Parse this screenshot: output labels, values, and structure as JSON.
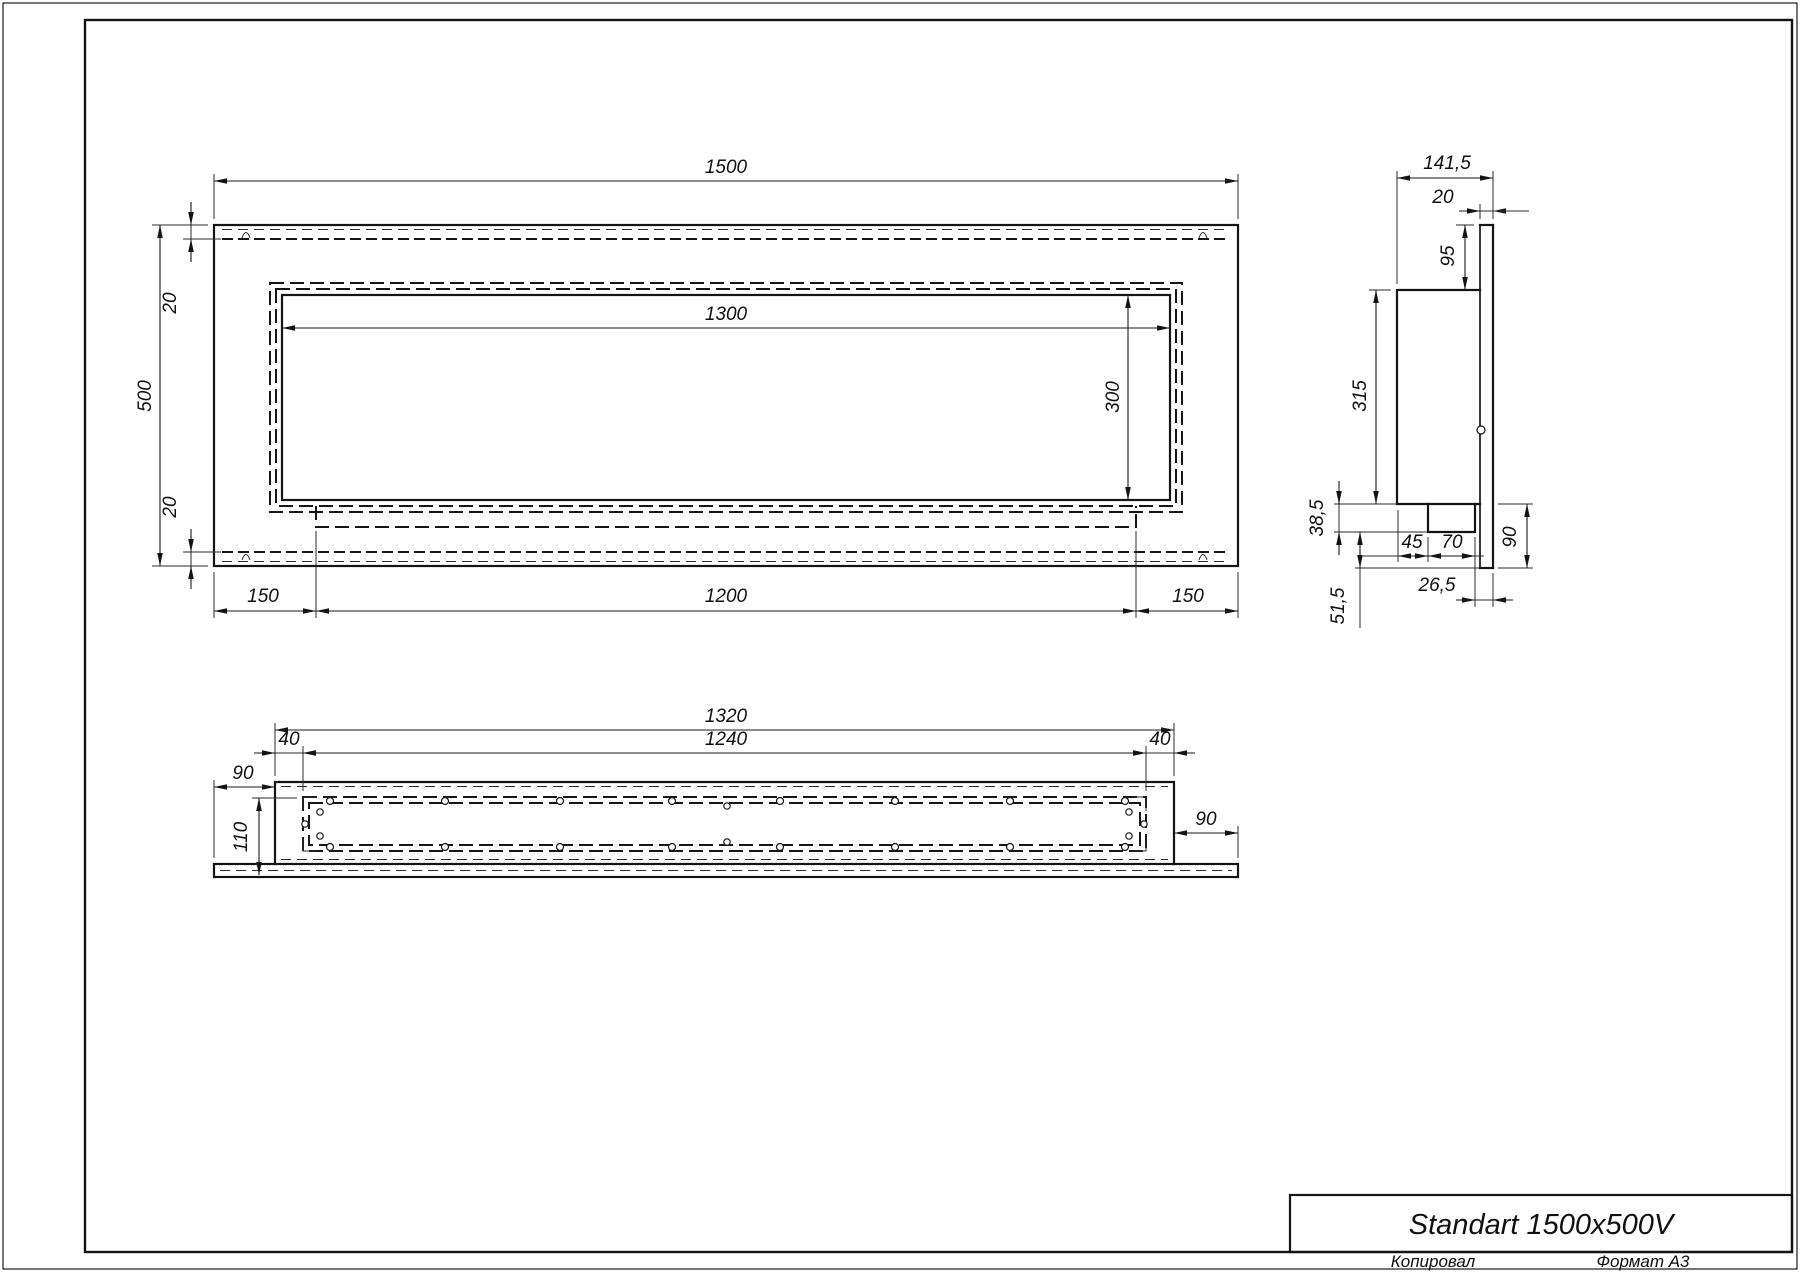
{
  "title_block": {
    "model": "Standart 1500x500V",
    "footer_copy": "Копировал",
    "footer_format": "Формат А3"
  },
  "front_view": {
    "overall_width": "1500",
    "overall_height": "500",
    "opening_width": "1300",
    "opening_height": "300",
    "top_inset": "20",
    "bottom_inset": "20",
    "left_margin": "150",
    "shelf_width": "1200",
    "right_margin": "150"
  },
  "side_view": {
    "overall_depth": "141,5",
    "plate_thickness": "20",
    "top_offset": "95",
    "body_height": "315",
    "tray_drop": "38,5",
    "tray_inset": "45",
    "tray_depth": "70",
    "lower_height": "90",
    "plate_overhang": "26,5",
    "bottom_offset": "51,5"
  },
  "bottom_view": {
    "body_width": "1320",
    "opening_width": "1240",
    "left_inset": "40",
    "right_inset": "40",
    "left_overhang": "90",
    "body_depth": "110",
    "right_overhang": "90"
  }
}
